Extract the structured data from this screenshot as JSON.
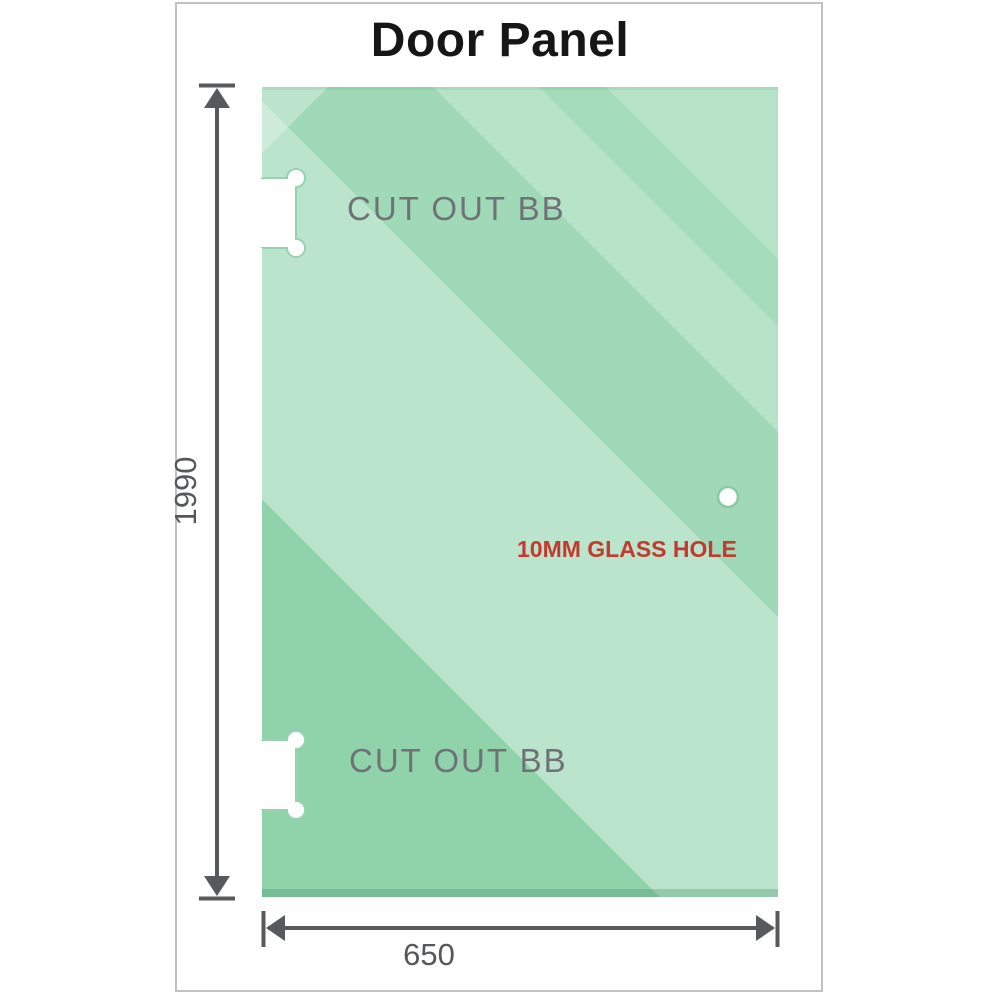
{
  "title": "Door Panel",
  "panel": {
    "cutouts": [
      {
        "label": "CUT OUT BB",
        "position": "top-left"
      },
      {
        "label": "CUT OUT BB",
        "position": "bottom-left"
      }
    ],
    "hole": {
      "label": "10MM GLASS HOLE"
    }
  },
  "dimensions": {
    "height": {
      "value": "1990"
    },
    "width": {
      "value": "650"
    }
  },
  "colors": {
    "background": "#ffffff",
    "frame_border": "#bfc1c3",
    "title_color": "#161616",
    "glass_base": "#90d3ab",
    "glass_highlight": "#c8e8d3",
    "glass_bottom_shadow": "#5ea47f",
    "cutout_fill": "#ffffff",
    "cutout_outline": "#96d2b1",
    "hole_fill": "#ffffff",
    "hole_ring": "#8ac8a6",
    "hole_label_red": "#c23a30",
    "cutout_label_gray": "#6f7276",
    "dimension_line": "#58595b"
  }
}
